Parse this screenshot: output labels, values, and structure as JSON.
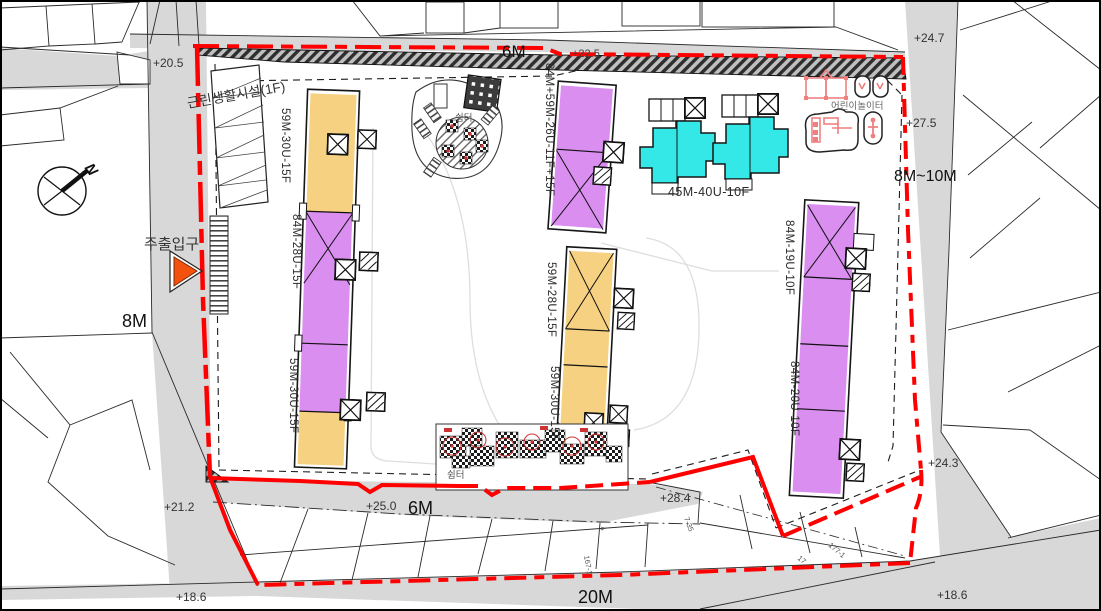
{
  "title": "apartment-site-plan",
  "compass": {
    "north": "N"
  },
  "amenities": {
    "facility": "근린생활시설(1F)",
    "entrance": "주출입구",
    "shelter_top": "쉼터",
    "shelter_bottom": "쉼터",
    "playground": "어린이놀이터"
  },
  "buildings": [
    {
      "label": "59M-30U-15F"
    },
    {
      "label": "84M-28U-15F"
    },
    {
      "label": "59M-30U-15F"
    },
    {
      "label": "84M+59M-26U-11F+15F"
    },
    {
      "label": "45M-40U-10F"
    },
    {
      "label": "59M-28U-15F"
    },
    {
      "label": "59M-30U-15F"
    },
    {
      "label": "84M-19U-10F"
    },
    {
      "label": "84M-20U-10F"
    }
  ],
  "roads": {
    "west": "8M",
    "top": "6M",
    "east": "8M~10M",
    "mid_south": "6M",
    "south": "20M"
  },
  "elevations": {
    "nw": "+20.5",
    "top_mid": "+22.5",
    "ne": "+24.7",
    "east_upper": "+27.5",
    "east_lower": "+24.3",
    "se": "+18.6",
    "sw": "+18.6",
    "sw_road": "+21.2",
    "six_m_west": "+25.0",
    "south_mid": "+28.4"
  },
  "parcel_numbers": [
    "4",
    "167-1",
    "7-35",
    "177-1",
    "17"
  ],
  "colors": {
    "boundary": "#ff0000",
    "unit_59": "#f6d182",
    "unit_84": "#d98ef0",
    "unit_45": "#35e8e8",
    "playground": "#f08080",
    "road": "#d8d8d8"
  }
}
